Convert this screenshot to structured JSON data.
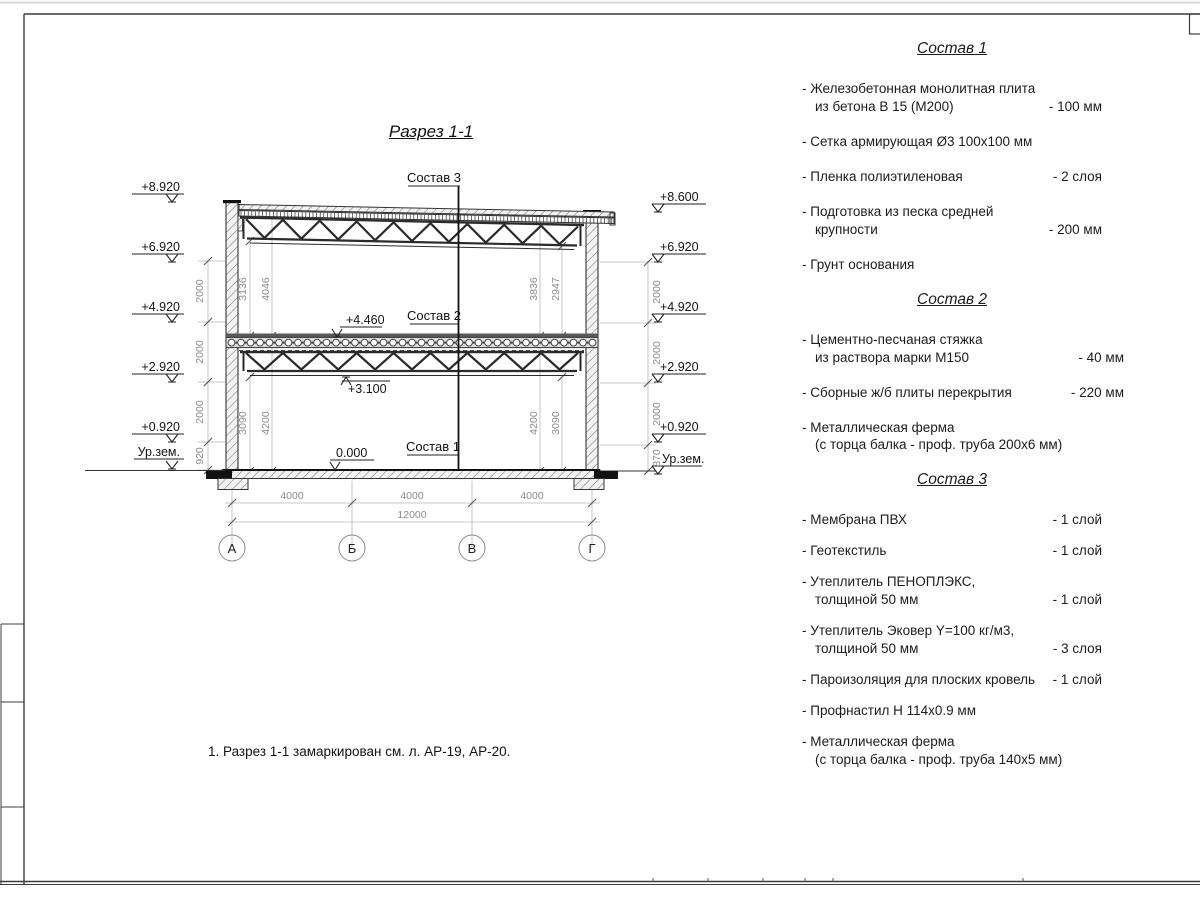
{
  "sheet": {
    "title": "Разрез 1-1",
    "note": "1. Разрез 1-1 замаркирован см. л. АР-19, АР-20."
  },
  "section": {
    "callouts": {
      "c3": "Состав 3",
      "c2": "Состав 2",
      "c1": "Состав 1"
    },
    "levels_left": [
      "+8.920",
      "+6.920",
      "+4.920",
      "+2.920",
      "+0.920"
    ],
    "levels_right": [
      "+8.600",
      "+6.920",
      "+4.920",
      "+2.920",
      "+0.920"
    ],
    "ground_label": "Ур.зем.",
    "marks": {
      "mid_top": "+4.460",
      "mid_bottom": "+3.100",
      "zero": "0.000"
    },
    "dims_left_chain": [
      "2000",
      "2000",
      "2000",
      "920"
    ],
    "dims_right_chain": [
      "2000",
      "2000",
      "2000",
      "870"
    ],
    "dims_inner": {
      "ul": [
        "3136",
        "4046"
      ],
      "ur": [
        "3836",
        "2947"
      ],
      "ll": [
        "3090",
        "4200"
      ],
      "lr": [
        "4200",
        "3090"
      ]
    },
    "dims_bottom": [
      "4000",
      "4000",
      "4000"
    ],
    "dim_total": "12000",
    "axes": [
      "А",
      "Б",
      "В",
      "Г"
    ]
  },
  "specs": [
    {
      "title": "Состав 1",
      "items": [
        {
          "name": "- Железобетонная  монолитная плита\nиз бетона В 15 (М200)",
          "value": "- 100 мм"
        },
        {
          "name": "- Сетка армирующая Ø3 100х100 мм",
          "value": ""
        },
        {
          "name": "- Пленка полиэтиленовая",
          "value": "-  2 слоя"
        },
        {
          "name": "- Подготовка из песка средней\nкрупности",
          "value": "- 200 мм"
        },
        {
          "name": "- Грунт основания",
          "value": ""
        }
      ]
    },
    {
      "title": "Состав 2",
      "items": [
        {
          "name": "- Цементно-песчаная стяжка\nиз раствора марки М150",
          "value": "- 40 мм"
        },
        {
          "name": "- Сборные ж/б плиты перекрытия",
          "value": "- 220 мм"
        },
        {
          "name": "- Металлическая ферма\n(с торца балка - проф. труба 200х6 мм)",
          "value": ""
        }
      ]
    },
    {
      "title": "Состав 3",
      "items": [
        {
          "name": "- Мембрана ПВХ",
          "value": "- 1 слой"
        },
        {
          "name": "- Геотекстиль",
          "value": "- 1 слой"
        },
        {
          "name": "- Утеплитель ПЕНОПЛЭКС,\nтолщиной 50 мм",
          "value": "- 1 слой"
        },
        {
          "name": "- Утеплитель Эковер Y=100 кг/м3,\nтолщиной 50 мм",
          "value": "- 3 слоя"
        },
        {
          "name": "- Пароизоляция для плоских кровель",
          "value": "- 1 слой"
        },
        {
          "name": "- Профнастил Н 114х0.9 мм",
          "value": ""
        },
        {
          "name": "- Металлическая ферма\n(с торца балка - проф. труба 140х5 мм)",
          "value": ""
        }
      ]
    }
  ]
}
